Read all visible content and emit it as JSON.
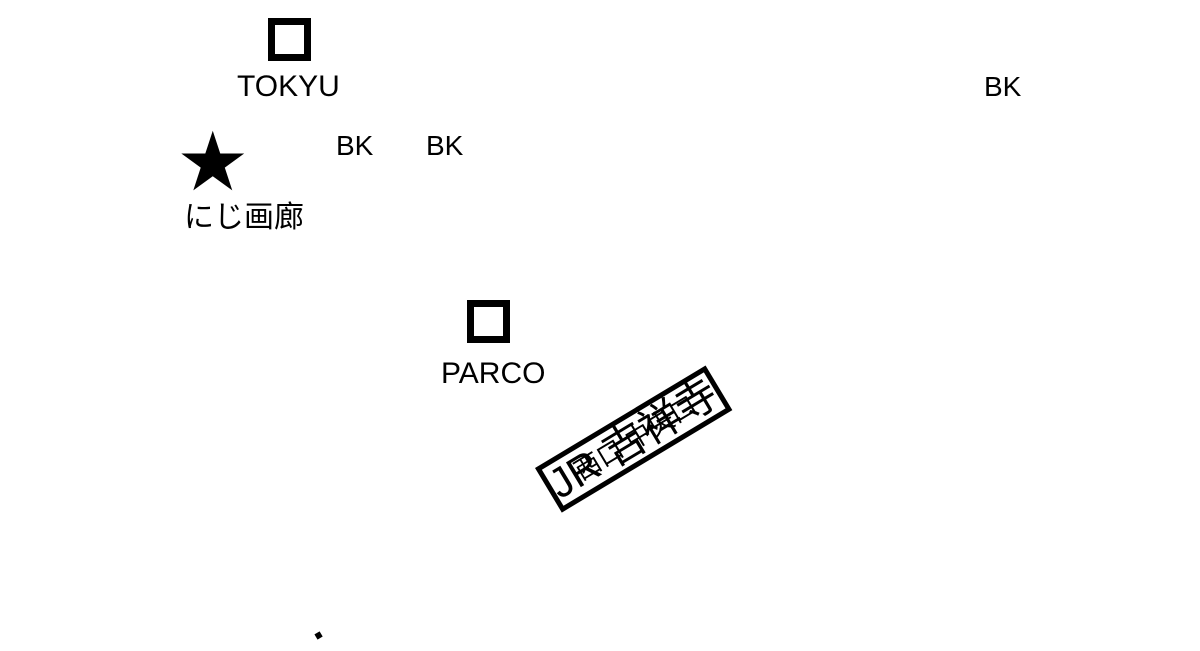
{
  "map": {
    "title": "Access map to Niji Gallery near JR Kichijoji station",
    "background_color": "#ffffff",
    "line_color": "#000000",
    "landmarks": {
      "tokyu_label": "TOKYU",
      "parco_label": "PARCO",
      "gallery_label": "にじ画廊",
      "gallery_marker": "★"
    },
    "banks": [
      "BK",
      "BK",
      "BK"
    ],
    "station": {
      "name": "JR 吉祥寺",
      "central_exit_label": "中央口",
      "west_exit_label": "西口"
    }
  }
}
